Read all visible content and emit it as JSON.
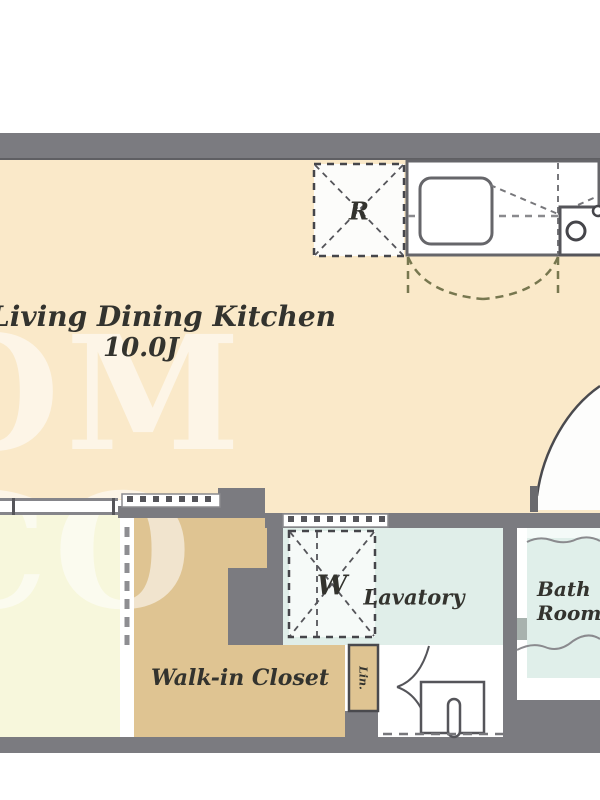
{
  "plan": {
    "watermark": "OM CO",
    "rooms": {
      "ldk": {
        "name": "Living Dining Kitchen",
        "size": "10.0J"
      },
      "walk_in_closet": {
        "name": "Walk-in Closet"
      },
      "lavatory": {
        "name": "Lavatory"
      },
      "bath_room": {
        "line1": "Bath",
        "line2": "Room"
      },
      "linen": {
        "name": "Lin."
      }
    },
    "symbols": {
      "refrigerator": "R",
      "washer": "W"
    },
    "colors": {
      "ldk_floor": "#fae9c9",
      "bedroom_floor": "#f7f7dc",
      "closet_floor": "#dfc492",
      "lavatory_floor": "#e0eee9",
      "bath_floor": "#e0efea",
      "wall": "#7b7b80",
      "line": "#55555a",
      "watermark_color": "rgba(255,255,255,0.55)"
    }
  }
}
